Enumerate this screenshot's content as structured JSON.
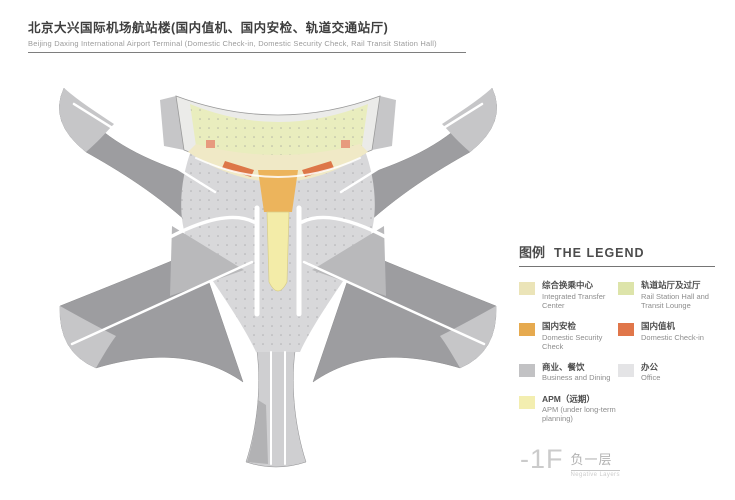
{
  "header": {
    "title_zh": "北京大兴国际机场航站楼(国内值机、国内安检、轨道交通站厅)",
    "title_en": "Beijing Daxing International Airport Terminal (Domestic Check-in, Domestic Security Check, Rail Transit Station Hall)"
  },
  "legend": {
    "title_zh": "图例",
    "title_en": "THE LEGEND",
    "items": [
      {
        "label_zh": "综合换乘中心",
        "label_en": "Integrated Transfer Center",
        "color": "#ebe4b8"
      },
      {
        "label_zh": "轨道站厅及过厅",
        "label_en": "Rail Station Hall and Transit Lounge",
        "color": "#dde4aa"
      },
      {
        "label_zh": "国内安检",
        "label_en": "Domestic Security Check",
        "color": "#e6aa4f"
      },
      {
        "label_zh": "国内值机",
        "label_en": "Domestic Check-in",
        "color": "#e0764a"
      },
      {
        "label_zh": "商业、餐饮",
        "label_en": "Business and Dining",
        "color": "#c2c2c4"
      },
      {
        "label_zh": "办公",
        "label_en": "Office",
        "color": "#e4e4e6"
      },
      {
        "label_zh": "APM（远期）",
        "label_en": "APM (under long-term planning)",
        "color": "#f3eeb0"
      }
    ]
  },
  "floor": {
    "code": "-1F",
    "name_zh": "负一层",
    "name_en": "Negative Layers"
  },
  "plan": {
    "colors": {
      "arm_gray": "#9d9da0",
      "tip_gray": "#c6c6c8",
      "wedge_gray": "#b9b9bb",
      "core_gray": "#d8d8da",
      "bottom_arm_gray": "#cfcfd1",
      "bottom_arm_dark": "#a8a8aa",
      "shell_gray": "#ebebe9",
      "wing_gray": "#c6c6c8",
      "outline_gray": "#9a9a9a",
      "rail_hall": "#e9edbe",
      "transfer_center": "#f0e9c6",
      "security": "#ecb45c",
      "apm": "#f3eca8",
      "checkin": "#dd7748",
      "checkin_accent": "#e79a7e",
      "road_white": "#ffffff",
      "dot_gray": "#8f8f92"
    }
  }
}
